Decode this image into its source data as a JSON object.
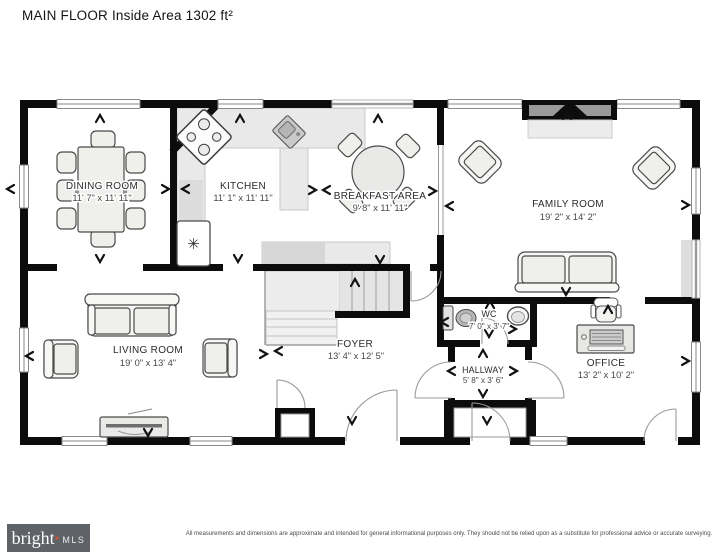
{
  "title": "MAIN FLOOR Inside Area 1302 ft²",
  "rooms": [
    {
      "name": "DINING ROOM",
      "dims": "11' 7\" x 11' 11\""
    },
    {
      "name": "KITCHEN",
      "dims": "11' 1\" x 11' 11\""
    },
    {
      "name": "BREAKFAST AREA",
      "dims": "9' 8\" x 11' 11\""
    },
    {
      "name": "FAMILY ROOM",
      "dims": "19' 2\" x 14' 2\""
    },
    {
      "name": "LIVING ROOM",
      "dims": "19' 0\" x 13' 4\""
    },
    {
      "name": "FOYER",
      "dims": "13' 4\" x 12' 5\""
    },
    {
      "name": "WC",
      "dims": "7' 0\" x 3' 7\""
    },
    {
      "name": "HALLWAY",
      "dims": "5' 8\" x 3' 6\""
    },
    {
      "name": "OFFICE",
      "dims": "13' 2\" x 10' 2\""
    }
  ],
  "fixtures": {
    "refrigerator_symbol": "✳"
  },
  "footer": {
    "brand": {
      "name": "bright",
      "star": "✶",
      "suffix": "MLS",
      "bg_color": "#5f6368",
      "star_color": "#e0532f"
    },
    "disclaimer": "All measurements and dimensions are approximate and intended for general informational purposes only. They should not be relied upon as a substitute for professional advice or accurate surveying."
  }
}
